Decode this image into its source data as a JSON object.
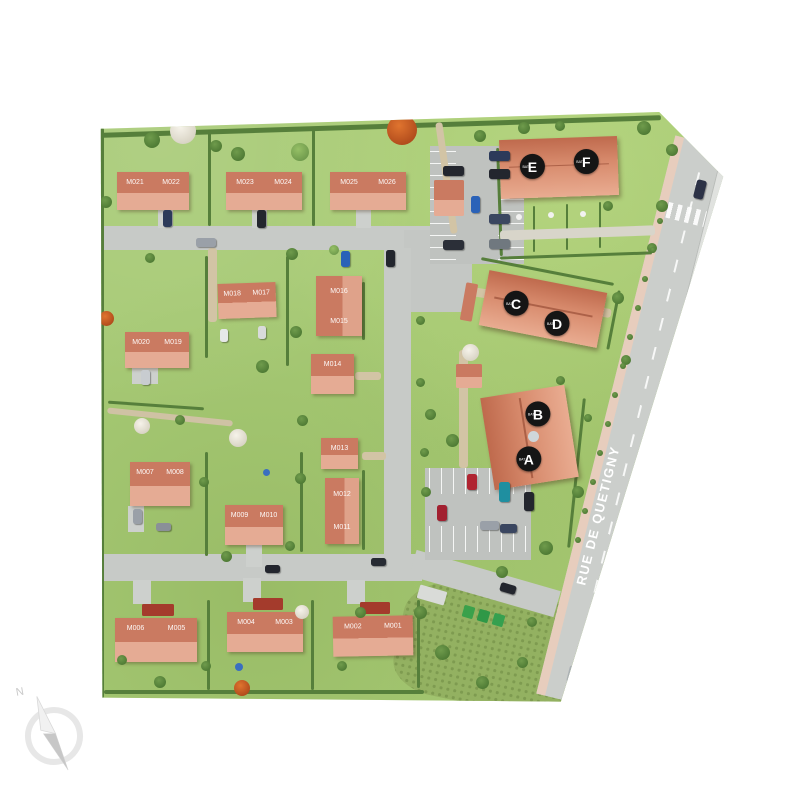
{
  "site_plan": {
    "street": {
      "name": "RUE DE QUETIGNY"
    },
    "compass": {
      "north_label": "N"
    },
    "badge_prefix": "BAT.",
    "apartment_badges": [
      {
        "id": "E"
      },
      {
        "id": "F"
      },
      {
        "id": "C"
      },
      {
        "id": "D"
      },
      {
        "id": "B"
      },
      {
        "id": "A"
      }
    ],
    "houses": [
      {
        "units": [
          "M021",
          "M022"
        ]
      },
      {
        "units": [
          "M023",
          "M024"
        ]
      },
      {
        "units": [
          "M025",
          "M026"
        ]
      },
      {
        "units": [
          "M020",
          "M019"
        ]
      },
      {
        "units": [
          "M018",
          "M017"
        ]
      },
      {
        "units": [
          "M016",
          "M015"
        ]
      },
      {
        "units": [
          "M014"
        ]
      },
      {
        "units": [
          "M013"
        ]
      },
      {
        "units": [
          "M012",
          "M011"
        ]
      },
      {
        "units": [
          "M009",
          "M010"
        ]
      },
      {
        "units": [
          "M007",
          "M008"
        ]
      },
      {
        "units": [
          "M006",
          "M005"
        ]
      },
      {
        "units": [
          "M004",
          "M003"
        ]
      },
      {
        "units": [
          "M002",
          "M001"
        ]
      }
    ],
    "colors": {
      "roof_dark": "#ca7a61",
      "roof_light": "#e5ab94",
      "building_roof": "#d78a6c",
      "grass": "#a7ca75",
      "road": "#c7cac7",
      "badge_background": "#151515",
      "street_text": "#ffffff"
    }
  }
}
